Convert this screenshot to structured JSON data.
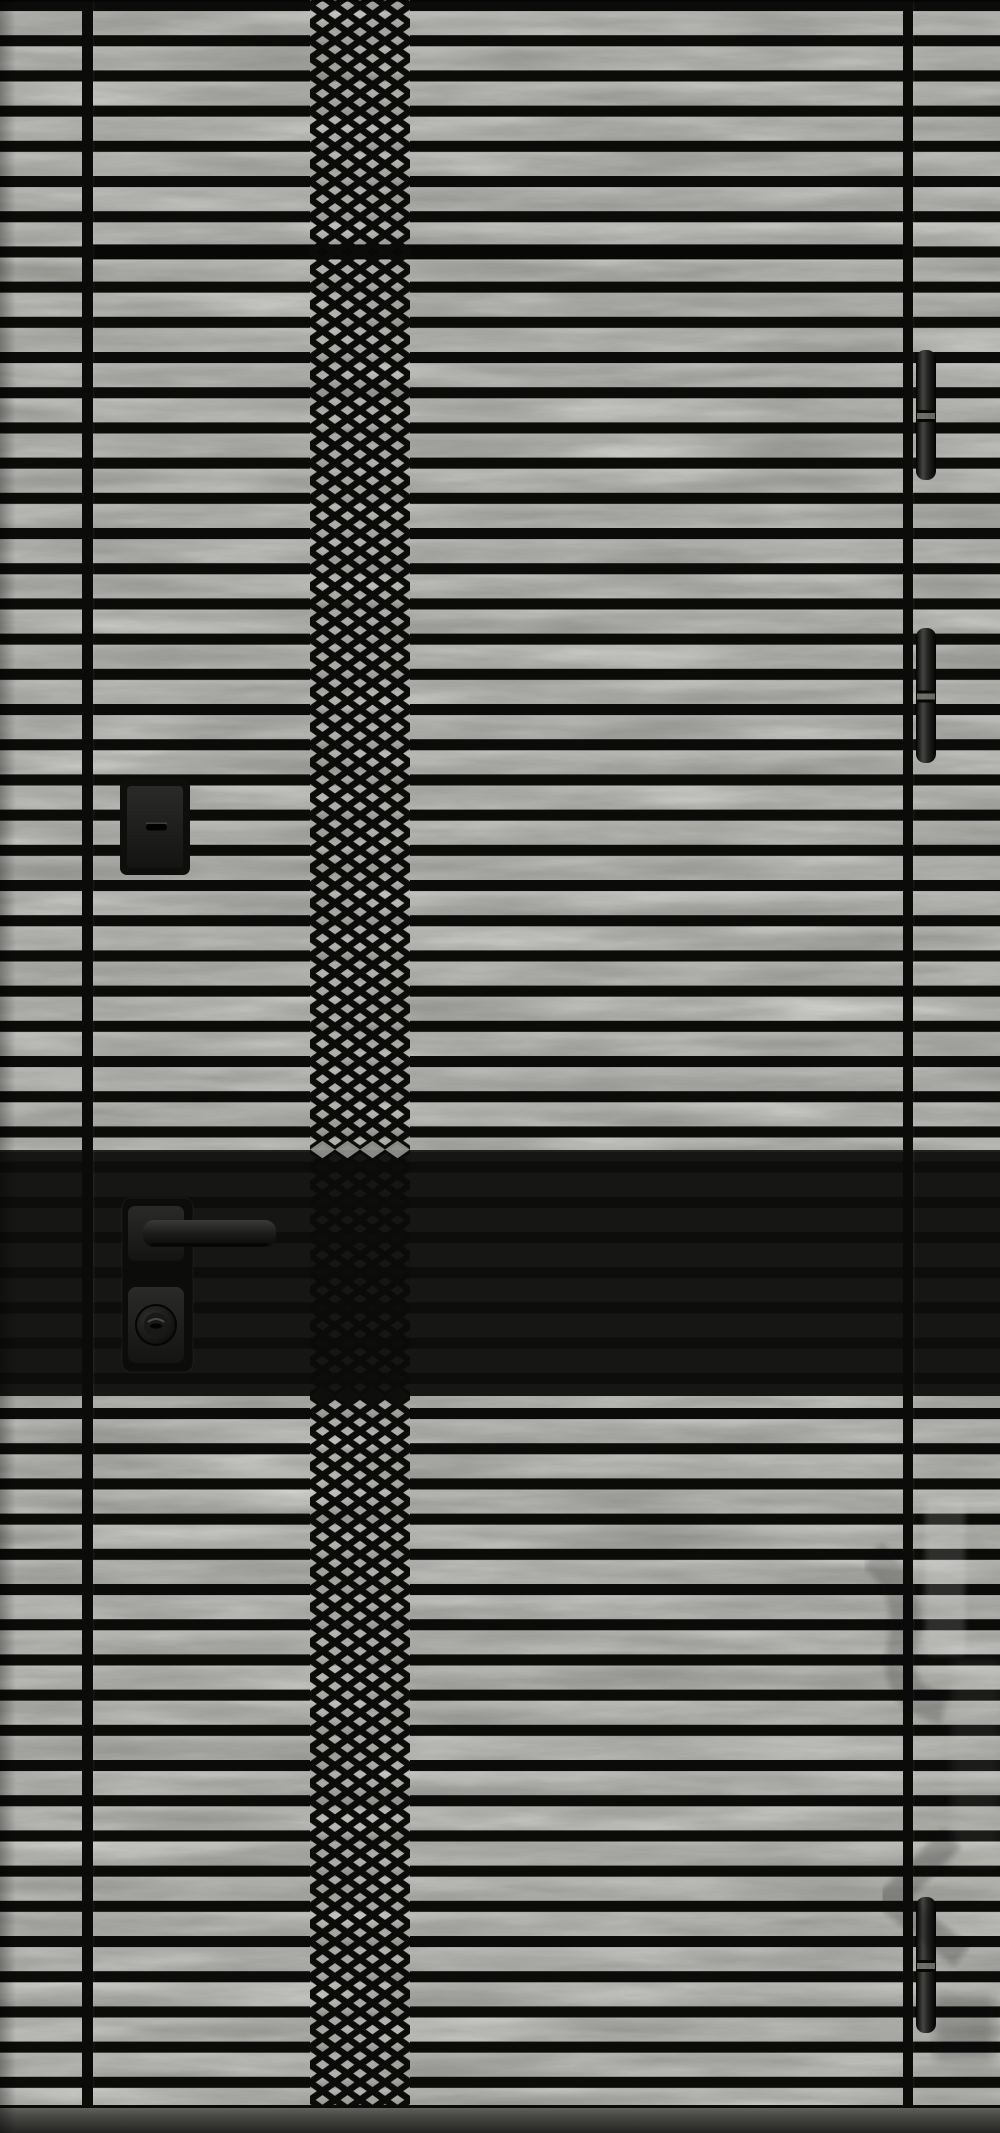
{
  "scene": {
    "kind": "product-photo",
    "subject": "modern entrance door, gray wood-grain laminate with black milled pattern",
    "width": 1000,
    "height": 2133
  },
  "palette": {
    "wood_base": "#8f8f8b",
    "wood_light": "#c9c9c4",
    "wood_dark": "#5e5e5a",
    "groove_black": "#0b0b0a",
    "band_black": "#161615",
    "hardware_black": "#0f0f0e",
    "hardware_highlight": "#4a4a46",
    "threshold_top": "#61615d",
    "threshold_bottom": "#242422"
  },
  "grooves": {
    "horizontal_count": 60,
    "first_center_y": 5.5,
    "pitch": 35.2,
    "thickness": 11,
    "seam_index": 7,
    "seam_x": 93,
    "seam_width": 810,
    "seam_thickness": 15
  },
  "vertical_grooves": [
    {
      "name": "left-frame-groove",
      "x": 82,
      "width": 11
    },
    {
      "name": "right-leaf-edge",
      "x": 903,
      "width": 10
    }
  ],
  "lattice": {
    "x": 310,
    "width": 100,
    "cell_width": 25,
    "cell_height": 17.6,
    "stroke": 6.5
  },
  "band": {
    "y": 1150,
    "height": 246
  },
  "threshold": {
    "y": 2108,
    "height": 25
  },
  "hinges": {
    "x": 916,
    "width": 20,
    "corner_radius": 9,
    "items": [
      {
        "y": 350,
        "height": 130
      },
      {
        "y": 628,
        "height": 135
      },
      {
        "y": 1897,
        "height": 136
      }
    ]
  },
  "upper_lock": {
    "x": 120,
    "y": 779,
    "w": 70,
    "h": 96,
    "inner": {
      "x": 127,
      "y": 786,
      "w": 56,
      "h": 82
    },
    "keyhole": {
      "x": 146,
      "y": 824,
      "w": 21,
      "h": 6.5
    }
  },
  "handle_set": {
    "backplate": {
      "x": 122,
      "y": 1198,
      "w": 71,
      "h": 174
    },
    "rose": {
      "x": 128,
      "y": 1206,
      "w": 56,
      "h": 55
    },
    "lever": {
      "x": 143,
      "y": 1220,
      "w": 133,
      "h": 27
    },
    "cylinder_plate": {
      "x": 128,
      "y": 1287,
      "w": 56,
      "h": 76
    },
    "knob": {
      "cx": 156,
      "cy": 1325,
      "r": 20
    }
  },
  "watermark": {
    "visible": true,
    "legible": false,
    "position": "right-edge-lower-half"
  }
}
